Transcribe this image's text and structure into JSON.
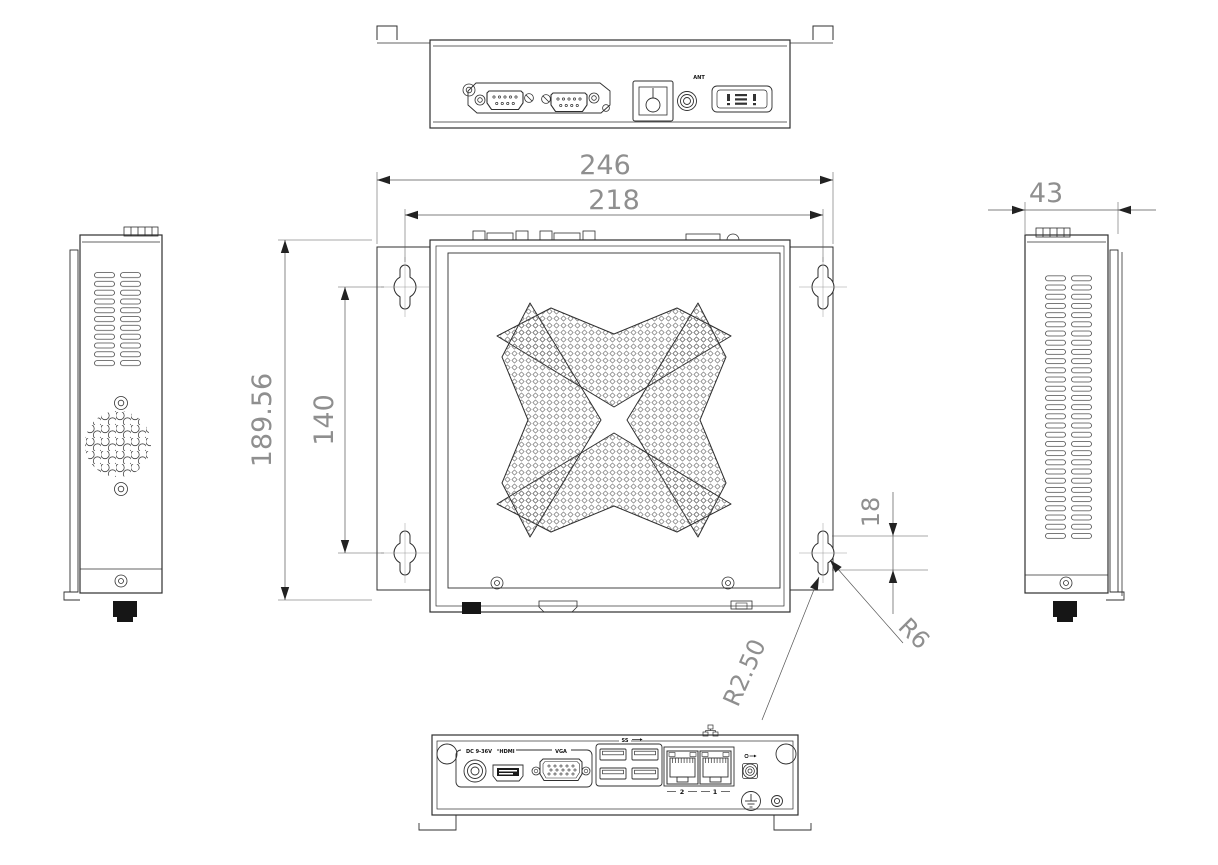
{
  "drawing": {
    "title": "industrial-box-pc-dimension-drawing",
    "dimensions": {
      "overall_width": "246",
      "mount_hole_width": "218",
      "overall_depth": "189.56",
      "mount_hole_depth": "140",
      "side_width": "43",
      "keyhole_slot_length": "18",
      "keyhole_radius_large": "R6",
      "keyhole_radius_small": "R2.50"
    },
    "rear_panel": {
      "antenna_label": "ANT"
    },
    "front_panel": {
      "dc_label": "DC 9-36V",
      "hdmi_label": "HDMI",
      "vga_label": "VGA",
      "usb_label": "SS",
      "lan2_label": "2",
      "lan1_label": "1"
    }
  }
}
